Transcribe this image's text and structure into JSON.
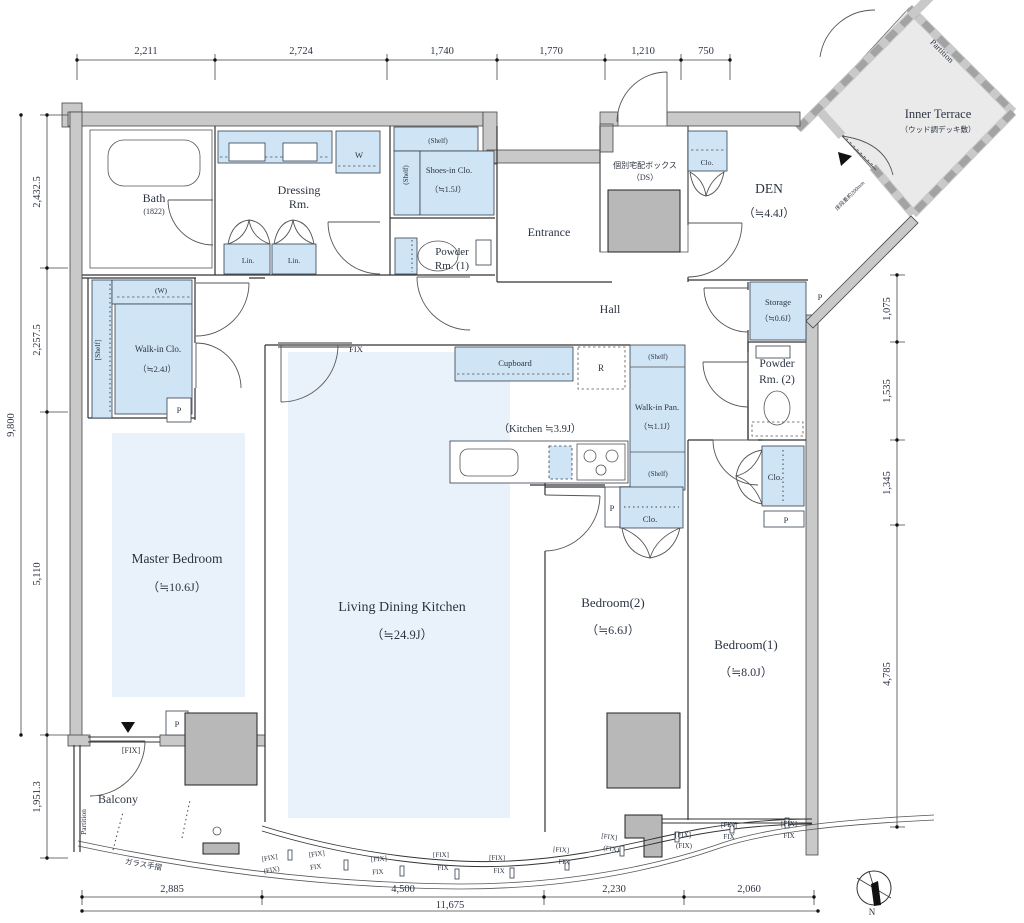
{
  "meta": {
    "type": "apartment-floor-plan",
    "colors": {
      "cabinet_blue": "#cfe4f4",
      "floor_blue": "#e9f2fa",
      "wall_gray": "#c9c9c9",
      "shaft_gray": "#b8b8b8",
      "terrace_gray": "#eaeaea",
      "line": "#333333",
      "text": "#2c3442"
    }
  },
  "labels": [
    {
      "n": "master-bedroom-label",
      "t": "Master Bedroom",
      "x": 177,
      "y": 563,
      "s": 13.5
    },
    {
      "n": "master-bedroom-size",
      "t": "（≒10.6J）",
      "x": 177,
      "y": 591,
      "s": 12
    },
    {
      "n": "ldk-label",
      "t": "Living Dining Kitchen",
      "x": 402,
      "y": 611,
      "s": 14
    },
    {
      "n": "ldk-size",
      "t": "（≒24.9J）",
      "x": 402,
      "y": 639,
      "s": 12.5
    },
    {
      "n": "bedroom2-label",
      "t": "Bedroom(2)",
      "x": 613,
      "y": 607,
      "s": 13
    },
    {
      "n": "bedroom2-size",
      "t": "（≒6.6J）",
      "x": 613,
      "y": 634,
      "s": 12
    },
    {
      "n": "bedroom1-label",
      "t": "Bedroom(1)",
      "x": 746,
      "y": 649,
      "s": 13
    },
    {
      "n": "bedroom1-size",
      "t": "（≒8.0J）",
      "x": 746,
      "y": 676,
      "s": 12
    },
    {
      "n": "den-label",
      "t": "DEN",
      "x": 769,
      "y": 193,
      "s": 13.5
    },
    {
      "n": "den-size",
      "t": "（≒4.4J）",
      "x": 769,
      "y": 217,
      "s": 11.5
    },
    {
      "n": "bath-label",
      "t": "Bath",
      "x": 154,
      "y": 202,
      "s": 12
    },
    {
      "n": "bath-size",
      "t": "(1822)",
      "x": 154,
      "y": 214,
      "s": 8
    },
    {
      "n": "dressing-label-1",
      "t": "Dressing",
      "x": 299,
      "y": 194,
      "s": 12
    },
    {
      "n": "dressing-label-2",
      "t": "Rm.",
      "x": 299,
      "y": 208,
      "s": 12
    },
    {
      "n": "entrance-label",
      "t": "Entrance",
      "x": 549,
      "y": 236,
      "s": 12
    },
    {
      "n": "hall-label",
      "t": "Hall",
      "x": 610,
      "y": 313,
      "s": 12
    },
    {
      "n": "balcony-label",
      "t": "Balcony",
      "x": 118,
      "y": 803,
      "s": 12
    },
    {
      "n": "inner-terrace-label",
      "t": "Inner Terrace",
      "x": 938,
      "y": 118,
      "s": 12.5
    },
    {
      "n": "inner-terrace-sub",
      "t": "（ウッド調デッキ敷）",
      "x": 938,
      "y": 132,
      "s": 7.5
    },
    {
      "n": "shoes-clo-label",
      "t": "Shoes-in Clo.",
      "x": 449,
      "y": 173,
      "s": 8.5
    },
    {
      "n": "shoes-clo-size",
      "t": "（≒1.5J）",
      "x": 448,
      "y": 192,
      "s": 8
    },
    {
      "n": "powder1-label-1",
      "t": "Powder",
      "x": 452,
      "y": 255,
      "s": 11
    },
    {
      "n": "powder1-label-2",
      "t": "Rm. (1)",
      "x": 452,
      "y": 269,
      "s": 11
    },
    {
      "n": "powder2-label-1",
      "t": "Powder",
      "x": 777,
      "y": 367,
      "s": 11.5
    },
    {
      "n": "powder2-label-2",
      "t": "Rm. (2)",
      "x": 777,
      "y": 383,
      "s": 11.5
    },
    {
      "n": "storage-label",
      "t": "Storage",
      "x": 778,
      "y": 305,
      "s": 8.5
    },
    {
      "n": "storage-size",
      "t": "（≒0.6J）",
      "x": 778,
      "y": 321,
      "s": 8
    },
    {
      "n": "walkin-clo-label",
      "t": "Walk-in Clo.",
      "x": 158,
      "y": 352,
      "s": 9
    },
    {
      "n": "walkin-clo-size",
      "t": "（≒2.4J）",
      "x": 157,
      "y": 372,
      "s": 8.5
    },
    {
      "n": "walkin-pan-label",
      "t": "Walk-in Pan.",
      "x": 657,
      "y": 410,
      "s": 8.5
    },
    {
      "n": "walkin-pan-size",
      "t": "（≒1.1J）",
      "x": 657,
      "y": 429,
      "s": 8
    },
    {
      "n": "kitchen-size",
      "t": "（Kitchen ≒3.9J）",
      "x": 540,
      "y": 432,
      "s": 10.5
    },
    {
      "n": "cupboard-label",
      "t": "Cupboard",
      "x": 515,
      "y": 366,
      "s": 8.5
    },
    {
      "n": "delivery-box-label",
      "t": "個別宅配ボックス",
      "x": 645,
      "y": 168,
      "s": 8
    },
    {
      "n": "delivery-box-sub",
      "t": "（DS）",
      "x": 645,
      "y": 180,
      "s": 8
    },
    {
      "n": "w-hanger-label",
      "t": "(W)",
      "x": 161,
      "y": 293,
      "s": 7.5
    },
    {
      "n": "shelf-walkin-label",
      "t": "[Shelf]",
      "x": 100,
      "y": 350,
      "s": 7.5,
      "r": -90
    },
    {
      "n": "shelf-shoes-top-label",
      "t": "(Shelf)",
      "x": 438,
      "y": 143,
      "s": 7
    },
    {
      "n": "shelf-shoes-left-label",
      "t": "(Shelf)",
      "x": 408,
      "y": 175,
      "s": 7,
      "r": -90
    },
    {
      "n": "shelf-pan-top-label",
      "t": "(Shelf)",
      "x": 658,
      "y": 359,
      "s": 7
    },
    {
      "n": "shelf-pan-bottom-label",
      "t": "(Shelf)",
      "x": 658,
      "y": 476,
      "s": 7
    },
    {
      "n": "washer-label",
      "t": "W",
      "x": 359,
      "y": 158,
      "s": 8.5
    },
    {
      "n": "fridge-label",
      "t": "R",
      "x": 601,
      "y": 371,
      "s": 9
    },
    {
      "n": "linen-label-1",
      "t": "Lin.",
      "x": 248,
      "y": 263,
      "s": 7.5
    },
    {
      "n": "linen-label-2",
      "t": "Lin.",
      "x": 294,
      "y": 263,
      "s": 7.5
    },
    {
      "n": "clo-den-label",
      "t": "Clo.",
      "x": 707,
      "y": 165,
      "s": 7.5
    },
    {
      "n": "clo-bedroom2-label",
      "t": "Clo.",
      "x": 650,
      "y": 522,
      "s": 8.5
    },
    {
      "n": "clo-bedroom1-label",
      "t": "Clo.",
      "x": 775,
      "y": 480,
      "s": 8.5
    },
    {
      "n": "p-walkin",
      "t": "P",
      "x": 179,
      "y": 413,
      "s": 8.5
    },
    {
      "n": "p-master",
      "t": "P",
      "x": 177,
      "y": 727,
      "s": 8.5
    },
    {
      "n": "p-kitchen",
      "t": "P",
      "x": 612,
      "y": 511,
      "s": 8.5
    },
    {
      "n": "p-storage",
      "t": "P",
      "x": 820,
      "y": 300,
      "s": 8.5
    },
    {
      "n": "p-bedroom1",
      "t": "P",
      "x": 786,
      "y": 523,
      "s": 8.5
    },
    {
      "n": "fix-ldk-label",
      "t": "FIX",
      "x": 356,
      "y": 352,
      "s": 8.5
    },
    {
      "n": "fix-master-label",
      "t": "[FIX]",
      "x": 131,
      "y": 753,
      "s": 8
    },
    {
      "n": "partition-terrace-label",
      "t": "Partition",
      "x": 940,
      "y": 53,
      "s": 8.5,
      "r": 45
    },
    {
      "n": "partition-balcony-label",
      "t": "Partition",
      "x": 86,
      "y": 822,
      "s": 7.5,
      "r": -90
    },
    {
      "n": "glass-rail-label",
      "t": "ガラス手摺",
      "x": 143,
      "y": 867,
      "s": 7.5,
      "r": 10
    },
    {
      "n": "step-note-label",
      "t": "床段差約200mm",
      "x": 851,
      "y": 197,
      "s": 5.5,
      "r": -45
    },
    {
      "n": "compass-n-label",
      "t": "N",
      "x": 872,
      "y": 915,
      "s": 9
    },
    {
      "n": "dim-top-1",
      "t": "2,211",
      "x": 146,
      "y": 54,
      "s": 10.5
    },
    {
      "n": "dim-top-2",
      "t": "2,724",
      "x": 301,
      "y": 54,
      "s": 10.5
    },
    {
      "n": "dim-top-3",
      "t": "1,740",
      "x": 442,
      "y": 54,
      "s": 10.5
    },
    {
      "n": "dim-top-4",
      "t": "1,770",
      "x": 551,
      "y": 54,
      "s": 10.5
    },
    {
      "n": "dim-top-5",
      "t": "1,210",
      "x": 643,
      "y": 54,
      "s": 10.5
    },
    {
      "n": "dim-top-6",
      "t": "750",
      "x": 706,
      "y": 54,
      "s": 10.5
    },
    {
      "n": "dim-left-1",
      "t": "2,432.5",
      "x": 40,
      "y": 192,
      "s": 10.5,
      "r": -90
    },
    {
      "n": "dim-left-2",
      "t": "2,257.5",
      "x": 40,
      "y": 340,
      "s": 10.5,
      "r": -90
    },
    {
      "n": "dim-left-3",
      "t": "5,110",
      "x": 40,
      "y": 574,
      "s": 10.5,
      "r": -90
    },
    {
      "n": "dim-left-4",
      "t": "1,951.3",
      "x": 40,
      "y": 797,
      "s": 10.5,
      "r": -90
    },
    {
      "n": "dim-left-total",
      "t": "9,800",
      "x": 14,
      "y": 425,
      "s": 10.5,
      "r": -90
    },
    {
      "n": "dim-right-1",
      "t": "1,075",
      "x": 890,
      "y": 309,
      "s": 10.5,
      "r": -90
    },
    {
      "n": "dim-right-2",
      "t": "1,535",
      "x": 890,
      "y": 391,
      "s": 10.5,
      "r": -90
    },
    {
      "n": "dim-right-3",
      "t": "1,345",
      "x": 890,
      "y": 483,
      "s": 10.5,
      "r": -90
    },
    {
      "n": "dim-right-4",
      "t": "4,785",
      "x": 890,
      "y": 674,
      "s": 10.5,
      "r": -90
    },
    {
      "n": "dim-bottom-1",
      "t": "2,885",
      "x": 172,
      "y": 892,
      "s": 10.5
    },
    {
      "n": "dim-bottom-2",
      "t": "4,500",
      "x": 403,
      "y": 892,
      "s": 10.5
    },
    {
      "n": "dim-bottom-3",
      "t": "2,230",
      "x": 614,
      "y": 892,
      "s": 10.5
    },
    {
      "n": "dim-bottom-4",
      "t": "2,060",
      "x": 749,
      "y": 892,
      "s": 10.5
    },
    {
      "n": "dim-bottom-total",
      "t": "11,675",
      "x": 450,
      "y": 908,
      "s": 10.5
    },
    {
      "n": "fix-curve-1a",
      "t": "[FIX]",
      "x": 270,
      "y": 860,
      "s": 7,
      "r": -10
    },
    {
      "n": "fix-curve-1b",
      "t": "(FIX)",
      "x": 272,
      "y": 872,
      "s": 7,
      "r": -10
    },
    {
      "n": "fix-curve-2a",
      "t": "[FIX]",
      "x": 317,
      "y": 856,
      "s": 7,
      "r": -7
    },
    {
      "n": "fix-curve-2b",
      "t": "FIX",
      "x": 316,
      "y": 869,
      "s": 7,
      "r": -7
    },
    {
      "n": "fix-curve-3a",
      "t": "[FIX]",
      "x": 379,
      "y": 861,
      "s": 7,
      "r": -4
    },
    {
      "n": "fix-curve-3b",
      "t": "FIX",
      "x": 378,
      "y": 874,
      "s": 7,
      "r": -4
    },
    {
      "n": "fix-curve-4a",
      "t": "[FIX]",
      "x": 441,
      "y": 857,
      "s": 7,
      "r": -1
    },
    {
      "n": "fix-curve-4b",
      "t": "FIX",
      "x": 443,
      "y": 870,
      "s": 7,
      "r": -1
    },
    {
      "n": "fix-curve-5a",
      "t": "[FIX]",
      "x": 497,
      "y": 860,
      "s": 7,
      "r": 2
    },
    {
      "n": "fix-curve-5b",
      "t": "FIX",
      "x": 499,
      "y": 873,
      "s": 7,
      "r": 2
    },
    {
      "n": "fix-curve-6a",
      "t": "[FIX]",
      "x": 561,
      "y": 852,
      "s": 7,
      "r": 5
    },
    {
      "n": "fix-curve-6b",
      "t": "FIX",
      "x": 564,
      "y": 864,
      "s": 7,
      "r": 5
    },
    {
      "n": "fix-curve-7a",
      "t": "[FIX]",
      "x": 609,
      "y": 839,
      "s": 7,
      "r": 8
    },
    {
      "n": "fix-curve-7b",
      "t": "(FIX)",
      "x": 611,
      "y": 851,
      "s": 7,
      "r": 8
    },
    {
      "n": "fix-curve-8a",
      "t": "[FIX]",
      "x": 683,
      "y": 837,
      "s": 7
    },
    {
      "n": "fix-curve-8b",
      "t": "(FIX)",
      "x": 684,
      "y": 848,
      "s": 7
    },
    {
      "n": "fix-curve-9a",
      "t": "[FIX]",
      "x": 729,
      "y": 827,
      "s": 7
    },
    {
      "n": "fix-curve-9b",
      "t": "FIX",
      "x": 729,
      "y": 839,
      "s": 7
    },
    {
      "n": "fix-curve-10a",
      "t": "[FIX]",
      "x": 789,
      "y": 826,
      "s": 7
    },
    {
      "n": "fix-curve-10b",
      "t": "FIX",
      "x": 789,
      "y": 838,
      "s": 7
    }
  ]
}
